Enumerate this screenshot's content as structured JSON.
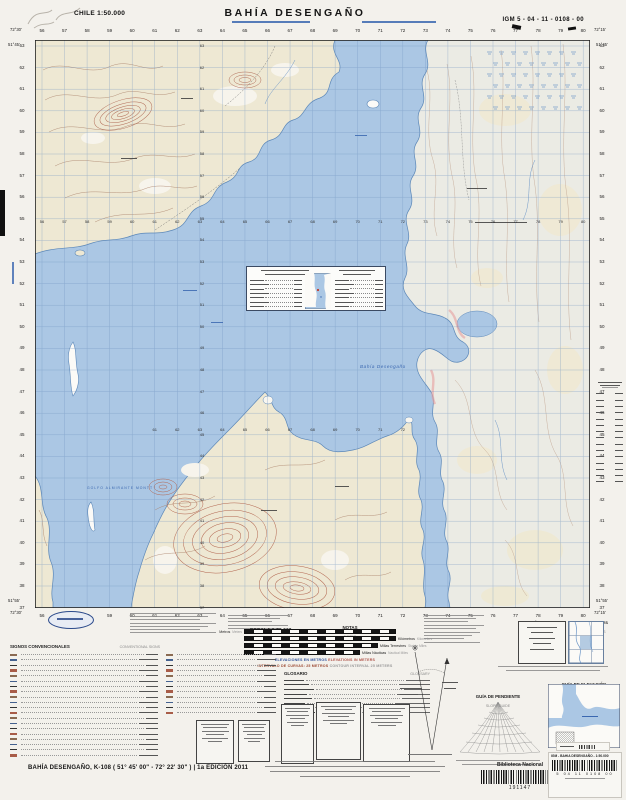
{
  "header": {
    "country_scale": "CHILE 1:50.000",
    "title": "BAHÍA  DESENGAÑO",
    "sheet_code": "IGM 5 - 04 - 11 - 0108 - 00"
  },
  "map": {
    "corners": {
      "tl_lon": "72°30'",
      "tl_lat": "51°45'",
      "tr_lon": "72°15'",
      "tr_lat": "51°45'",
      "bl_lon": "72°30'",
      "bl_lat": "51°55'",
      "br_lon": "72°15'",
      "br_lat": "51°55'"
    },
    "labels": {
      "bay": "Bahía Desengaño",
      "gulf": "GOLFO ALMIRANTE MONTT"
    },
    "grid": {
      "top_numbers": [
        "56",
        "57",
        "58",
        "59",
        "60",
        "61",
        "62",
        "63",
        "64",
        "65",
        "66",
        "67",
        "68",
        "69",
        "70",
        "71",
        "72",
        "73",
        "74",
        "75",
        "76",
        "77",
        "78",
        "79",
        "80"
      ],
      "left_numbers": [
        "63",
        "62",
        "61",
        "60",
        "59",
        "58",
        "57",
        "56",
        "55",
        "54",
        "53",
        "52",
        "51",
        "50",
        "49",
        "48",
        "47",
        "46",
        "45",
        "44",
        "43",
        "42",
        "41",
        "40",
        "39",
        "38",
        "37"
      ]
    }
  },
  "legend": {
    "signos_title": "SIGNOS CONVENCIONALES",
    "signos_title_en": "CONVENTIONAL SIGNS",
    "glosario_title": "GLOSARIO",
    "glosario_title_en": "GLOSSARY",
    "notas_title": "NOTAS",
    "notas_title_en": "NOTES"
  },
  "scale_block": {
    "escala": "ESCALA 1:50.000",
    "scale_en": "SCALE 1:50,000",
    "bars": [
      {
        "es": "Metros",
        "en": "Meters"
      },
      {
        "es": "Kilómetros",
        "en": "Kilometers"
      },
      {
        "es": "Millas Terrestres",
        "en": "Statute Miles"
      },
      {
        "es": "Millas Náuticas",
        "en": "Nautical Miles"
      }
    ],
    "elev_es": "ELEVACIONES EN METROS",
    "elev_en": "ELEVATIONS IN METERS",
    "interval_es": "INTERVALO DE CURVAS: 25 METROS",
    "interval_en": "CONTOUR INTERVAL 25 METERS"
  },
  "right_panel": {
    "limites": "LÍMITES",
    "boundaries": "BOUNDARIES",
    "hojas": "HOJAS ADYACENTES",
    "adjoining": "ADJOINING SHEETS",
    "guia_elevacion": "GUÍA DE ELEVACIÓN",
    "elevation_guide": "ELEVATION GUIDE",
    "guia_pendiente": "GUÍA DE PENDIENTE",
    "slope_guide": "SLOPE GUIDE"
  },
  "footer": {
    "sheet_line": "BAHÍA  DESENGAÑO, K-108 ( 51° 45' 00\" - 72° 22' 30\" ) | 1a EDICIÓN 2011",
    "library_name": "Biblioteca Nacional",
    "library_code": "191147",
    "sticker_title": "IGM - BAHIA DESENGAÑO - 1:50.000",
    "sticker_numbers": "5   04   11   0108   00"
  },
  "colors": {
    "water": "#abc7e4",
    "land": "#eee8d3",
    "contour": "#a87e66",
    "accent_blue": "#3a67b0"
  }
}
